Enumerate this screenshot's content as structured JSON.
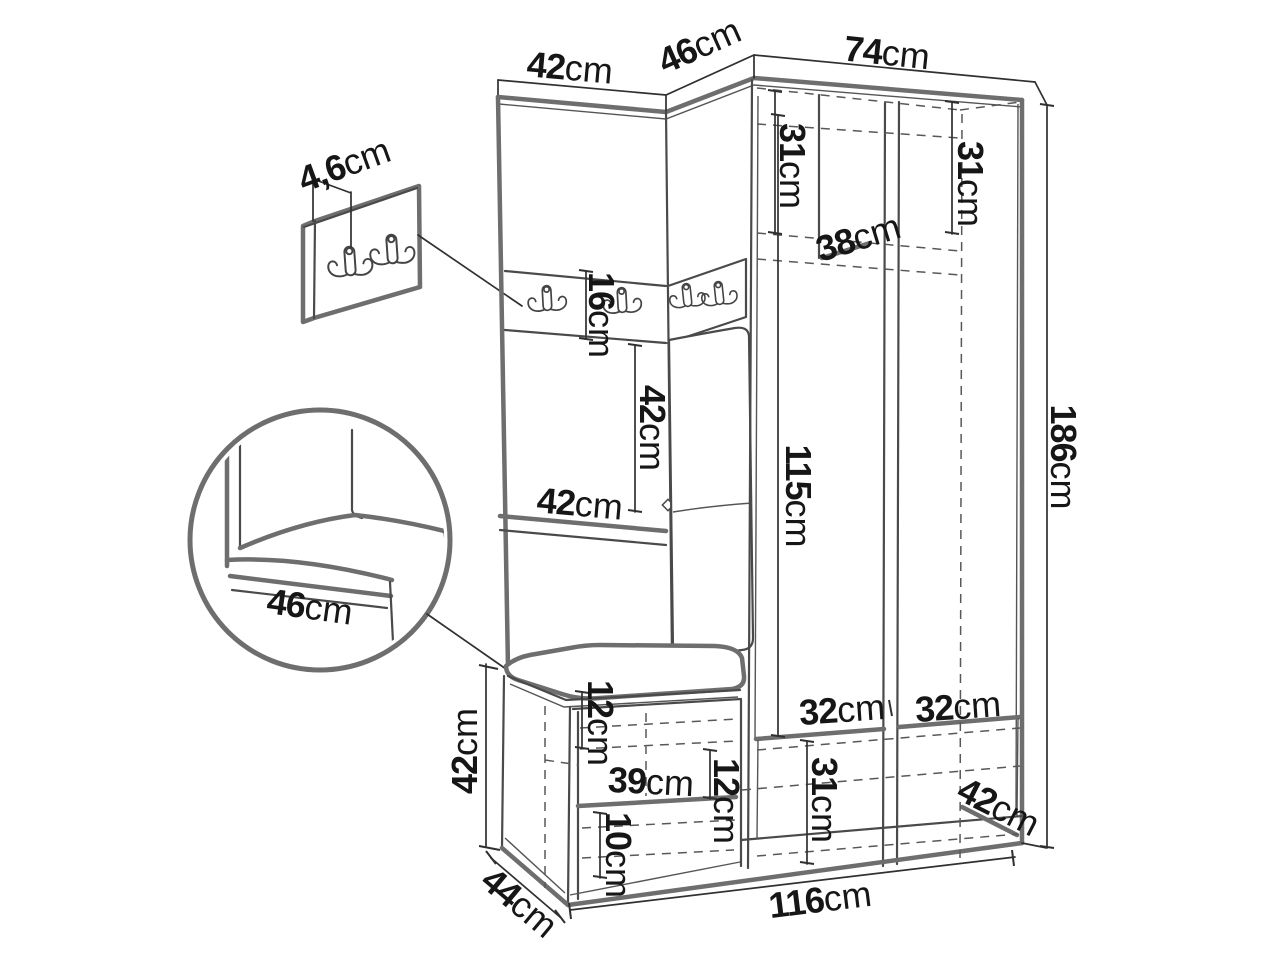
{
  "figure": {
    "type": "furniture dimension diagram",
    "subject": "hallway wardrobe set with coat-hook strip, wardrobe doors, shoe bench, wall hook panel and magnified seat-corner detail",
    "unit": "cm",
    "colors": {
      "background": "#ffffff",
      "line_heavy": "#6e6e6e",
      "line_light": "#303030",
      "line_dashed": "#585858",
      "text": "#161616"
    }
  },
  "details": {
    "wall_hook_panel": {
      "hooks": 2
    },
    "cabinet_hook_strip": {
      "hooks": 4
    },
    "seat_corner_detail": {
      "shape": "circle"
    }
  },
  "dimensions": {
    "top_left_width": {
      "v": "42",
      "u": "cm"
    },
    "top_middle_width": {
      "v": "46",
      "u": "cm"
    },
    "top_right_width": {
      "v": "74",
      "u": "cm"
    },
    "wall_panel_thickness": {
      "v": "4,6",
      "u": "cm"
    },
    "upper_left_shelf_height": {
      "v": "31",
      "u": "cm"
    },
    "upper_right_shelf_height": {
      "v": "31",
      "u": "cm"
    },
    "upper_shelf_depth": {
      "v": "38",
      "u": "cm"
    },
    "hook_strip_height": {
      "v": "16",
      "u": "cm"
    },
    "middle_panel_height": {
      "v": "42",
      "u": "cm"
    },
    "middle_shelf_width": {
      "v": "42",
      "u": "cm"
    },
    "door_height": {
      "v": "115",
      "u": "cm"
    },
    "total_height": {
      "v": "186",
      "u": "cm"
    },
    "detail_seat_depth": {
      "v": "46",
      "u": "cm"
    },
    "bench_height": {
      "v": "42",
      "u": "cm"
    },
    "bench_depth": {
      "v": "44",
      "u": "cm"
    },
    "bench_top_gap_height": {
      "v": "12",
      "u": "cm"
    },
    "bench_shelf_width": {
      "v": "39",
      "u": "cm"
    },
    "bench_side_gap_height": {
      "v": "12",
      "u": "cm"
    },
    "bench_bottom_gap_height": {
      "v": "10",
      "u": "cm"
    },
    "lower_left_compartment_width": {
      "v": "32",
      "u": "cm"
    },
    "lower_right_compartment_width": {
      "v": "32",
      "u": "cm"
    },
    "lower_drawer_height": {
      "v": "31",
      "u": "cm"
    },
    "lower_depth": {
      "v": "42",
      "u": "cm"
    },
    "total_width": {
      "v": "116",
      "u": "cm"
    }
  }
}
